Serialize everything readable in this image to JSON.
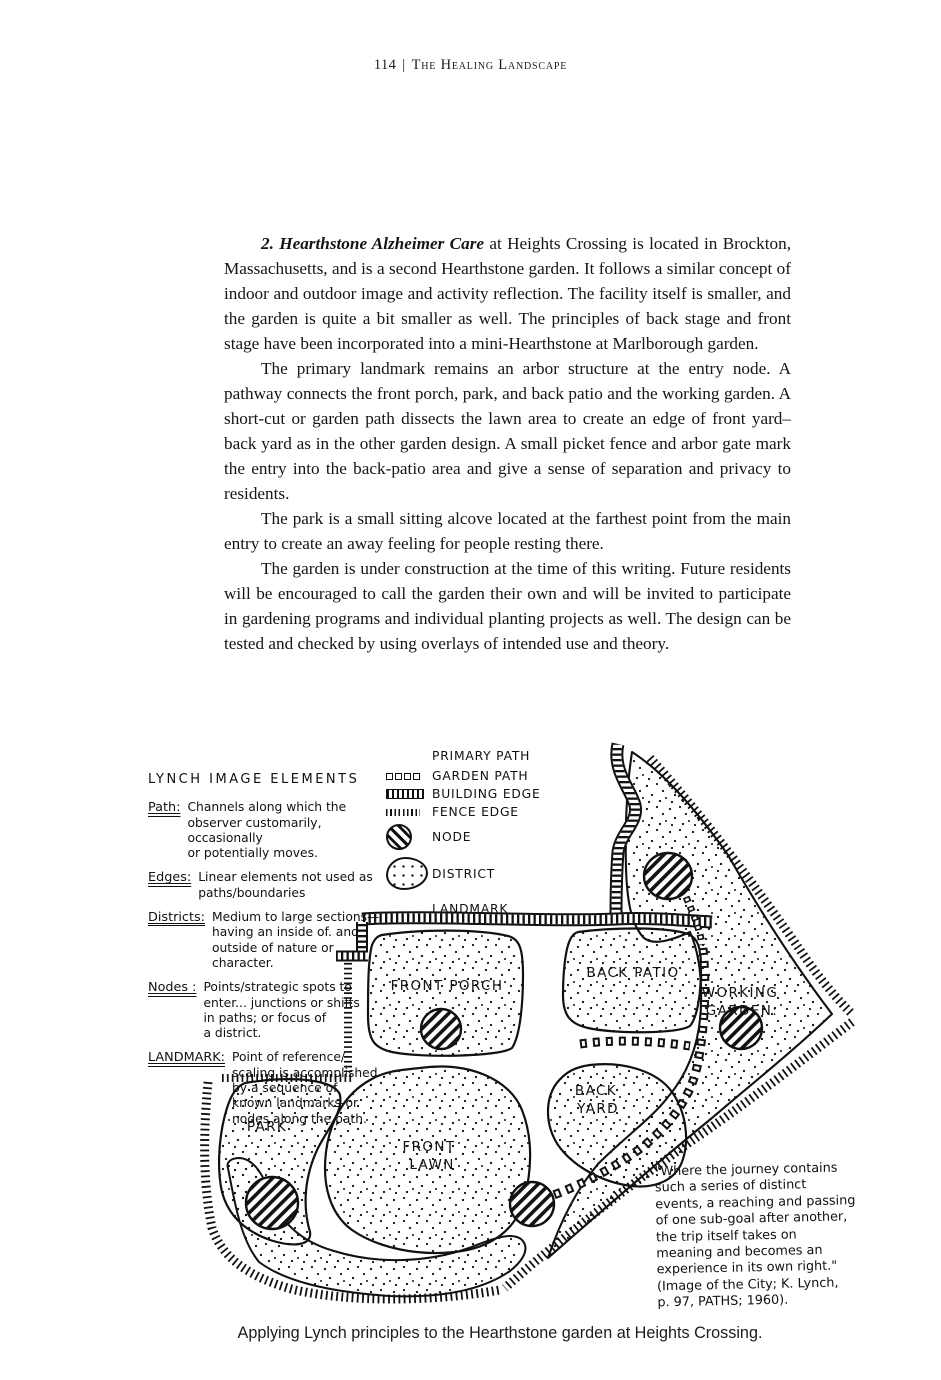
{
  "header": {
    "page_number": "114",
    "separator": "|",
    "book_title": "The Healing Landscape"
  },
  "body": {
    "para1_lead": "2. Hearthstone Alzheimer Care",
    "para1_rest": " at Heights Crossing is located in Brockton, Massachusetts, and is a second Hearthstone garden. It follows a similar concept of indoor and outdoor image and activity reflection. The facility itself is smaller, and the garden is quite a bit smaller as well. The principles of back stage and front stage have been incorporated into a mini-Hearthstone at Marlborough garden.",
    "para2": "The primary landmark remains an arbor structure at the entry node. A pathway connects the front porch, park, and back patio and the working garden. A short-cut or garden path dissects the lawn area to create an edge of front yard–back yard as in the other garden design. A small picket fence and arbor gate mark the entry into the back-patio area and give a sense of separation and privacy to residents.",
    "para3": "The park is a small sitting alcove located at the farthest point from the main entry to create an away feeling for people resting there.",
    "para4": "The garden is under construction at the time of this writing. Future residents will be encouraged to call the garden their own and will be invited to participate in gardening programs and individual planting projects as well. The design can be tested and checked by using overlays of intended use and theory."
  },
  "diagram": {
    "legend_title": "LYNCH IMAGE ELEMENTS",
    "legend": [
      {
        "term": "Path:",
        "lines": [
          "Channels along which the",
          "observer customarily, occasionally",
          "or potentially moves."
        ]
      },
      {
        "term": "Edges:",
        "lines": [
          "Linear elements not used as",
          "paths/boundaries"
        ]
      },
      {
        "term": "Districts:",
        "lines": [
          "Medium to large sections—",
          "having an inside of. and",
          "outside of nature or",
          "character."
        ]
      },
      {
        "term": "Nodes :",
        "lines": [
          "Points/strategic spots to",
          "enter... junctions or shifts",
          "in paths; or focus of",
          "a district."
        ]
      },
      {
        "term": "LANDMARK:",
        "lines": [
          "Point of reference/",
          "scaling is accomplished",
          "by a sequence of",
          "known landmarks-or",
          "nodes along the path."
        ]
      }
    ],
    "key": [
      {
        "label": "PRIMARY PATH"
      },
      {
        "label": "GARDEN PATH"
      },
      {
        "label": "BUILDING EDGE"
      },
      {
        "label": "FENCE EDGE"
      },
      {
        "label": "NODE"
      },
      {
        "label": "DISTRICT"
      },
      {
        "label": "LANDMARK"
      }
    ],
    "map_labels": {
      "front_porch": "FRONT PORCH",
      "back_patio": "BACK PATIO",
      "working_garden_1": "WORKING",
      "working_garden_2": "GARDEN:",
      "back_yard_1": "BACK",
      "back_yard_2": "YARD",
      "park": "PARK",
      "front_lawn_1": "FRONT",
      "front_lawn_2": "LAWN"
    },
    "quote_lines": [
      "\"Where the journey contains",
      "such a series of distinct",
      "events, a reaching and passing",
      "of one sub-goal after another,",
      "the trip itself takes on",
      "meaning and becomes an",
      "experience in its own right.\"",
      "(Image of the City; K. Lynch,",
      "p. 97, PATHS; 1960)."
    ]
  },
  "caption": "Applying Lynch principles to the Hearthstone garden at Heights Crossing."
}
